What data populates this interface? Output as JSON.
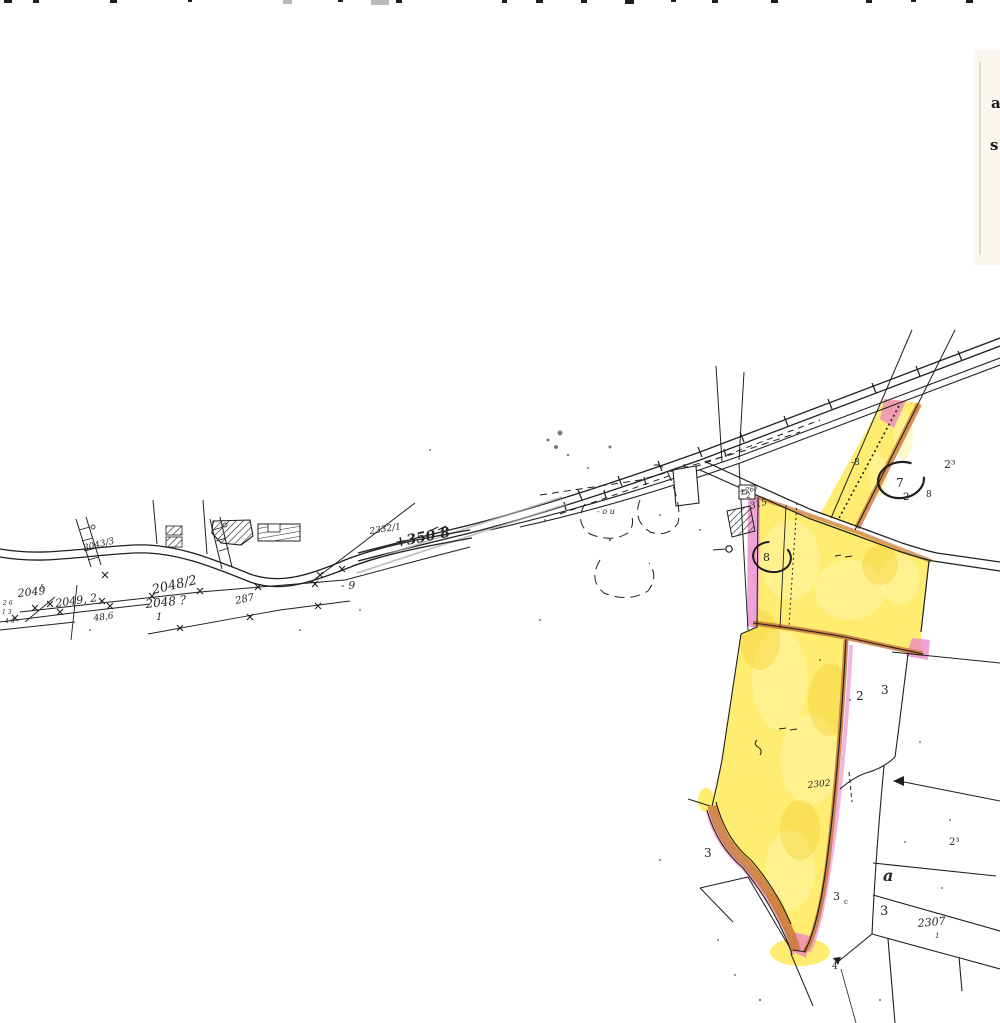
{
  "document_kind": "scanned cadastral map sheet with highlighted parcels",
  "colors": {
    "paper": "#ffffff",
    "ink": "#1f1f1f",
    "pencil_gray": "#a8a8a8",
    "highlight_yellow": "#ffe94e",
    "highlight_yellow_pale": "#fff6a6",
    "highlight_orange": "#c9763a",
    "highlight_pink": "#e87fc8",
    "cream_edge": "#efe8d2"
  },
  "labels": [
    {
      "name": "parcel-3043-3",
      "text": "3043/3",
      "x": 84,
      "y": 551,
      "rot": -14,
      "size": 9,
      "italic": true
    },
    {
      "name": "parcel-2049",
      "text": "2049",
      "x": 18,
      "y": 597,
      "rot": -6,
      "size": 11,
      "italic": true
    },
    {
      "name": "micro-5",
      "text": "5",
      "x": 40,
      "y": 589,
      "rot": 0,
      "size": 6,
      "italic": true
    },
    {
      "name": "parcel-2049-2",
      "text": "2049, 2",
      "x": 56,
      "y": 607,
      "rot": -8,
      "size": 11,
      "italic": true
    },
    {
      "name": "parcel-2048-2",
      "text": "2048/2",
      "x": 153,
      "y": 594,
      "rot": -13,
      "size": 13,
      "italic": true
    },
    {
      "name": "parcel-2048",
      "text": "2048 ?",
      "x": 146,
      "y": 608,
      "rot": -6,
      "size": 12,
      "italic": true
    },
    {
      "name": "parcel-2048-denominator",
      "text": "1",
      "x": 156,
      "y": 620,
      "rot": 0,
      "size": 10,
      "italic": true
    },
    {
      "name": "parcel-287",
      "text": "287",
      "x": 236,
      "y": 604,
      "rot": -12,
      "size": 10,
      "italic": true
    },
    {
      "name": "measure-48-6",
      "text": "48,6",
      "x": 94,
      "y": 621,
      "rot": -8,
      "size": 9,
      "italic": true
    },
    {
      "name": "micro-2-6",
      "text": "2 6",
      "x": 3,
      "y": 605,
      "rot": 0,
      "size": 6,
      "italic": true
    },
    {
      "name": "micro-1-3",
      "text": "1 3",
      "x": 2,
      "y": 614,
      "rot": 0,
      "size": 6,
      "italic": true
    },
    {
      "name": "micro-4-6",
      "text": "4 6",
      "x": 5,
      "y": 623,
      "rot": 0,
      "size": 6,
      "italic": true
    },
    {
      "name": "parcel-2332-1",
      "text": "2332/1",
      "x": 370,
      "y": 534,
      "rot": -9,
      "size": 9,
      "italic": true
    },
    {
      "name": "annotation-350-8",
      "text": "+350 8",
      "x": 396,
      "y": 547,
      "rot": -11,
      "size": 14,
      "italic": true,
      "bold": true
    },
    {
      "name": "mark-minus-9",
      "text": "- 9",
      "x": 341,
      "y": 589,
      "rot": 0,
      "size": 11,
      "italic": true
    },
    {
      "name": "mark-o-u",
      "text": "- o u",
      "x": 597,
      "y": 514,
      "rot": 0,
      "size": 8,
      "italic": true
    },
    {
      "name": "annotation-267",
      "text": "+267",
      "x": 740,
      "y": 494,
      "rot": -12,
      "size": 7,
      "italic": true
    },
    {
      "name": "marker-box-2",
      "text": "2",
      "x": 746,
      "y": 498,
      "rot": 0,
      "size": 7
    },
    {
      "name": "annotation-315",
      "text": "315",
      "x": 751,
      "y": 509,
      "rot": -16,
      "size": 9,
      "italic": true
    },
    {
      "name": "mark-minus-8",
      "text": "-8",
      "x": 851,
      "y": 465,
      "rot": 0,
      "size": 9
    },
    {
      "name": "circled-7",
      "text": "7",
      "x": 896,
      "y": 487,
      "rot": 0,
      "size": 12
    },
    {
      "name": "label-2-under-ellipse",
      "text": "2",
      "x": 903,
      "y": 500,
      "rot": 0,
      "size": 10
    },
    {
      "name": "label-8-right-of-strip",
      "text": "8",
      "x": 926,
      "y": 497,
      "rot": 0,
      "size": 9
    },
    {
      "name": "label-2-sup3-top",
      "text": "2³",
      "x": 944,
      "y": 468,
      "rot": 0,
      "size": 11
    },
    {
      "name": "circled-8",
      "text": "8",
      "x": 763,
      "y": 561,
      "rot": 0,
      "size": 11
    },
    {
      "name": "label-2-mid-parcel",
      "text": "2",
      "x": 856,
      "y": 700,
      "rot": 0,
      "size": 12
    },
    {
      "name": "label-3-mid-parcel",
      "text": "3",
      "x": 881,
      "y": 694,
      "rot": 0,
      "size": 12
    },
    {
      "name": "annotation-2302",
      "text": "2302",
      "x": 808,
      "y": 788,
      "rot": -6,
      "size": 9,
      "italic": true
    },
    {
      "name": "label-3-left-of-parcel",
      "text": "3",
      "x": 704,
      "y": 857,
      "rot": 0,
      "size": 12
    },
    {
      "name": "label-3-edge",
      "text": "3",
      "x": 833,
      "y": 900,
      "rot": 0,
      "size": 11
    },
    {
      "name": "label-3-edge-sub-c",
      "text": "c",
      "x": 844,
      "y": 904,
      "rot": 0,
      "size": 7
    },
    {
      "name": "label-a",
      "text": "a",
      "x": 883,
      "y": 881,
      "rot": 0,
      "size": 16,
      "italic": true,
      "bold": true
    },
    {
      "name": "label-3-lower",
      "text": "3",
      "x": 880,
      "y": 915,
      "rot": 0,
      "size": 13
    },
    {
      "name": "parcel-2307",
      "text": "2307",
      "x": 918,
      "y": 927,
      "rot": -5,
      "size": 11,
      "italic": true
    },
    {
      "name": "parcel-2307-sub-1",
      "text": "1",
      "x": 935,
      "y": 938,
      "rot": 0,
      "size": 7,
      "italic": true
    },
    {
      "name": "label-2-sup3-bottom",
      "text": "2³",
      "x": 949,
      "y": 845,
      "rot": 0,
      "size": 10
    },
    {
      "name": "label-4-tip",
      "text": "4",
      "x": 832,
      "y": 969,
      "rot": 0,
      "size": 9
    }
  ],
  "right_edge_letters": [
    {
      "name": "clipped-letter-a",
      "text": "a",
      "x": 991,
      "y": 108,
      "size": 15
    },
    {
      "name": "clipped-letter-s",
      "text": "s",
      "x": 990,
      "y": 150,
      "size": 15
    }
  ],
  "top_edge_marks": [
    {
      "x": 4,
      "w": 8,
      "h": 3
    },
    {
      "x": 33,
      "w": 6,
      "h": 3
    },
    {
      "x": 110,
      "w": 7,
      "h": 3
    },
    {
      "x": 188,
      "w": 4,
      "h": 2
    },
    {
      "x": 283,
      "w": 9,
      "h": 4,
      "gray": true
    },
    {
      "x": 338,
      "w": 5,
      "h": 2
    },
    {
      "x": 371,
      "w": 18,
      "h": 5,
      "gray": true
    },
    {
      "x": 396,
      "w": 6,
      "h": 3
    },
    {
      "x": 502,
      "w": 5,
      "h": 3
    },
    {
      "x": 536,
      "w": 7,
      "h": 3
    },
    {
      "x": 581,
      "w": 6,
      "h": 3
    },
    {
      "x": 625,
      "w": 9,
      "h": 4
    },
    {
      "x": 671,
      "w": 5,
      "h": 2
    },
    {
      "x": 712,
      "w": 6,
      "h": 3
    },
    {
      "x": 771,
      "w": 7,
      "h": 3
    },
    {
      "x": 866,
      "w": 6,
      "h": 3
    },
    {
      "x": 911,
      "w": 5,
      "h": 2
    },
    {
      "x": 966,
      "w": 7,
      "h": 3
    }
  ]
}
